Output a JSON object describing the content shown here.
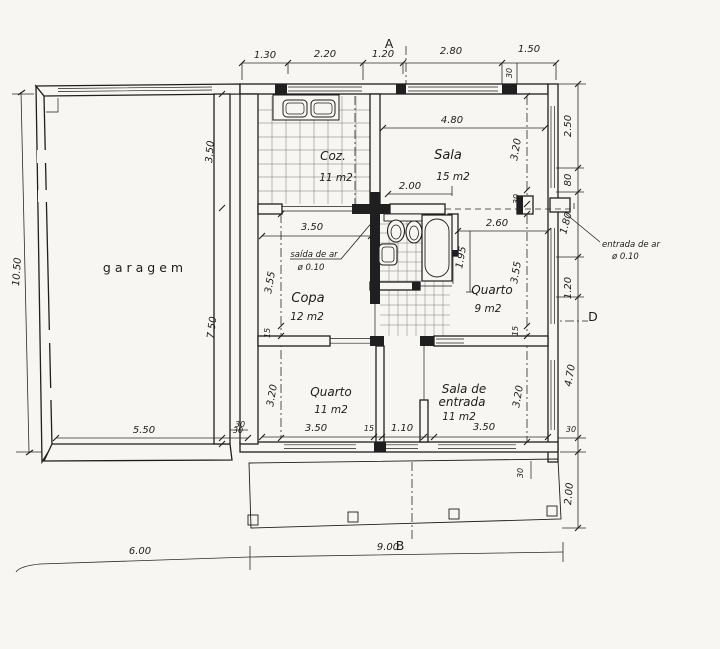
{
  "markers": {
    "top": "A",
    "bottom": "B",
    "right": "D"
  },
  "rooms": {
    "garage": {
      "name": "garagem"
    },
    "kitchen": {
      "name": "Coz.",
      "area": "11 m2"
    },
    "living": {
      "name": "Sala",
      "area": "15 m2"
    },
    "copa": {
      "name": "Copa",
      "area": "12 m2"
    },
    "bedroom9": {
      "name": "Quarto",
      "area": "9 m2"
    },
    "bedroom11": {
      "name": "Quarto",
      "area": "11 m2"
    },
    "entry": {
      "line1": "Sala de",
      "line2": "entrada",
      "area": "11 m2"
    }
  },
  "annotations": {
    "air_outlet": {
      "label": "saída de ar",
      "dia": "ø 0.10"
    },
    "air_inlet": {
      "label": "entrada de ar",
      "dia": "ø 0.10"
    }
  },
  "dims": {
    "top": {
      "d1": "1.30",
      "d2": "2.20",
      "d3": "1.20",
      "d4": "2.80",
      "d5": "1.50",
      "wall": "30"
    },
    "right": {
      "d1": "2.50",
      "d2": "80",
      "d3": "1.80",
      "d4": "1.20",
      "d5": "4.70",
      "wall": "30",
      "porch": "2.00"
    },
    "right_inner": {
      "sala": "3.20",
      "wall": "30",
      "quarto": "3.55",
      "wall2": "15",
      "entry": "3.20"
    },
    "left": {
      "total": "10.50"
    },
    "garage": {
      "upper": "3.50",
      "lower": "7.50",
      "width": "5.50",
      "wall": "30",
      "wall2": "30"
    },
    "bottom": {
      "left": "6.00",
      "right": "9.00"
    },
    "living": {
      "width": "4.80",
      "door": "2.00"
    },
    "copa": {
      "width": "3.50",
      "depth": "3.55",
      "wall": "15"
    },
    "quarto9": {
      "width": "2.60",
      "depth": "1.95"
    },
    "quarto11": {
      "depth": "3.20",
      "width": "3.50",
      "wall": "15",
      "hall": "1.10"
    },
    "entry": {
      "width": "3.50",
      "depth": "3.20"
    },
    "porch": {
      "wall": "30"
    }
  }
}
